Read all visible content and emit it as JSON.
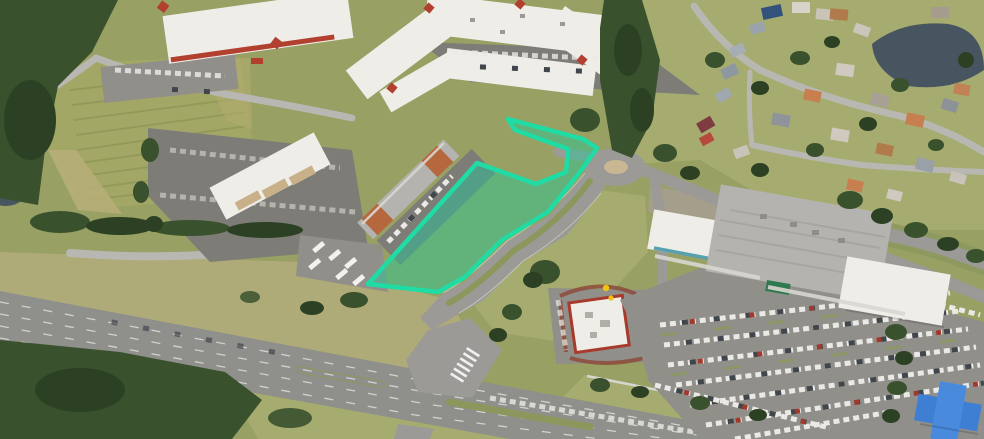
{
  "image": {
    "kind": "aerial-site-photo",
    "highlight": {
      "name": "highlighted-parcel",
      "fill_color": "#18CE9A",
      "fill_opacity": 0.42,
      "stroke_color": "#1FDCA4",
      "stroke_width": 4.5,
      "points": "368,284 477,163 536,184 566,172 568,149 515,130 508,119 583,139 597,148 580,172 548,212 502,240 465,277 438,292"
    },
    "palette": {
      "grass": "#98A064",
      "grass_light": "#A6AC6F",
      "grass_dry": "#AFAB78",
      "grass_med": "#8B975C",
      "trees": "#3A512E",
      "trees_dark": "#2C4123",
      "field": "#A3A766",
      "road": "#9C9A96",
      "highway": "#8F8F8B",
      "asphalt": "#7E7C77",
      "asphalt_light": "#918F8A",
      "roof_white": "#EFEDE8",
      "roof_gray": "#B5B3AF",
      "roof_red": "#B2402F",
      "pond": "#475560",
      "mcd_yellow": "#F2C114",
      "blue_roof": "#3F7FD3",
      "publix_green": "#2F7A4E",
      "mulch_red": "#8D4A38",
      "teal_trim": "#57A0AD"
    }
  }
}
